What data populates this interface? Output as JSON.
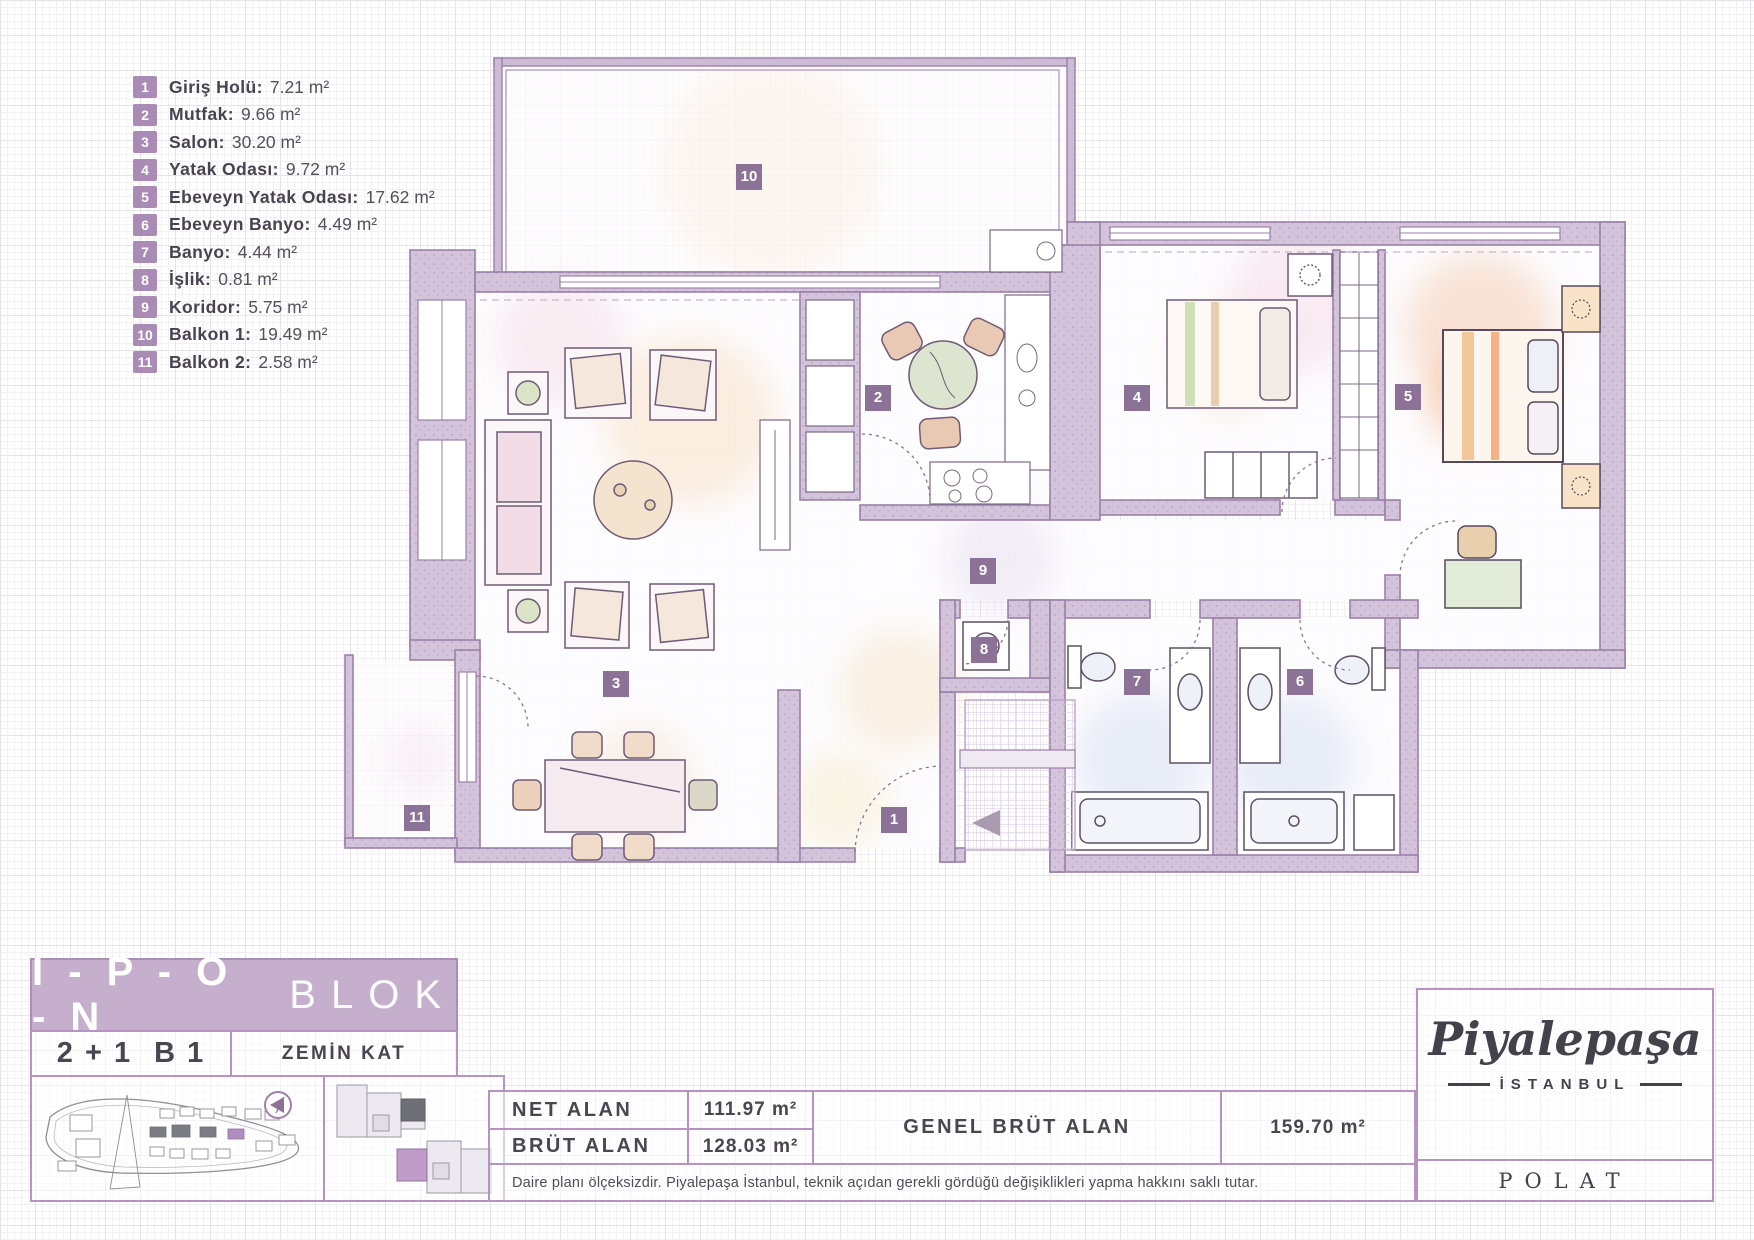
{
  "legend": {
    "unit": "m²",
    "items": [
      {
        "id": "1",
        "name": "Giriş Holü:",
        "area": "7.21 m²"
      },
      {
        "id": "2",
        "name": "Mutfak:",
        "area": "9.66 m²"
      },
      {
        "id": "3",
        "name": "Salon:",
        "area": "30.20 m²"
      },
      {
        "id": "4",
        "name": "Yatak Odası:",
        "area": "9.72 m²"
      },
      {
        "id": "5",
        "name": "Ebeveyn Yatak Odası:",
        "area": "17.62 m²"
      },
      {
        "id": "6",
        "name": "Ebeveyn Banyo:",
        "area": "4.49 m²"
      },
      {
        "id": "7",
        "name": "Banyo:",
        "area": "4.44 m²"
      },
      {
        "id": "8",
        "name": "İşlik:",
        "area": "0.81 m²"
      },
      {
        "id": "9",
        "name": "Koridor:",
        "area": "5.75 m²"
      },
      {
        "id": "10",
        "name": "Balkon 1:",
        "area": "19.49 m²"
      },
      {
        "id": "11",
        "name": "Balkon 2:",
        "area": "2.58 m²"
      }
    ]
  },
  "block": {
    "building": "I - P - O - N",
    "building_suffix": "BLOK",
    "unit_type": "2 + 1",
    "unit_code": "B 1",
    "floor": "ZEMİN KAT"
  },
  "areas": {
    "net_label": "NET ALAN",
    "net_value": "111.97 m²",
    "brut_label": "BRÜT ALAN",
    "brut_value": "128.03 m²",
    "genel_label": "GENEL BRÜT ALAN",
    "genel_value": "159.70 m²"
  },
  "disclaimer": "Daire planı ölçeksizdir. Piyalepaşa İstanbul, teknik açıdan gerekli gördüğü değişiklikleri yapma hakkını saklı tutar.",
  "brand": {
    "name": "Piyalepaşa",
    "city": "İSTANBUL",
    "company": "POLAT"
  },
  "icons": {
    "compass": "compass-icon",
    "entrance_arrow": "entrance-arrow-icon"
  },
  "colors": {
    "accent": "#a287ae",
    "banner": "#c6afcd",
    "badge": "#8c7296",
    "legend_chip": "#aa8bb5",
    "wall": "#d3c4db",
    "text": "#4a454e"
  }
}
